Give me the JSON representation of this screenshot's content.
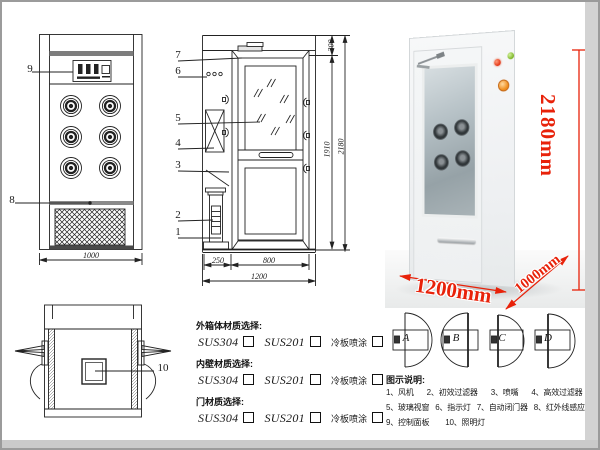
{
  "colors": {
    "dimension_red": "#e8220a",
    "line": "#222222",
    "photo_side": "#d6dadd"
  },
  "front_view": {
    "callout_9": "9",
    "callout_8": "8",
    "width_dim": "1000"
  },
  "side_view": {
    "callouts": [
      "7",
      "6",
      "5",
      "4",
      "3",
      "2",
      "1"
    ],
    "dims": {
      "d300": "300",
      "d1910": "1910",
      "d2180": "2180",
      "d250": "250",
      "d800": "800",
      "d1200": "1200"
    }
  },
  "top_view": {
    "callout_10": "10"
  },
  "photo": {
    "height_label": "2180mm",
    "width_label": "1200mm",
    "depth_label": "1000mm"
  },
  "materials": {
    "sections": [
      {
        "title": "外箱体材质选择:",
        "opt1": "SUS304",
        "opt2": "SUS201",
        "opt3": "冷板喷涂"
      },
      {
        "title": "内壁材质选择:",
        "opt1": "SUS304",
        "opt2": "SUS201",
        "opt3": "冷板喷涂"
      },
      {
        "title": "门材质选择:",
        "opt1": "SUS304",
        "opt2": "SUS201",
        "opt3": "冷板喷涂"
      }
    ]
  },
  "door_options": [
    {
      "label": "A"
    },
    {
      "label": "B"
    },
    {
      "label": "C"
    },
    {
      "label": "D"
    }
  ],
  "legend": {
    "title": "图示说明:",
    "row1": [
      "1、风机",
      "2、初效过滤器",
      "3、喷嘴",
      "4、高效过滤器"
    ],
    "row2": [
      "5、玻璃视窗",
      "6、指示灯",
      "7、自动闭门器",
      "8、红外线感应器"
    ],
    "row3": [
      "9、控制面板",
      "10、照明灯"
    ]
  }
}
